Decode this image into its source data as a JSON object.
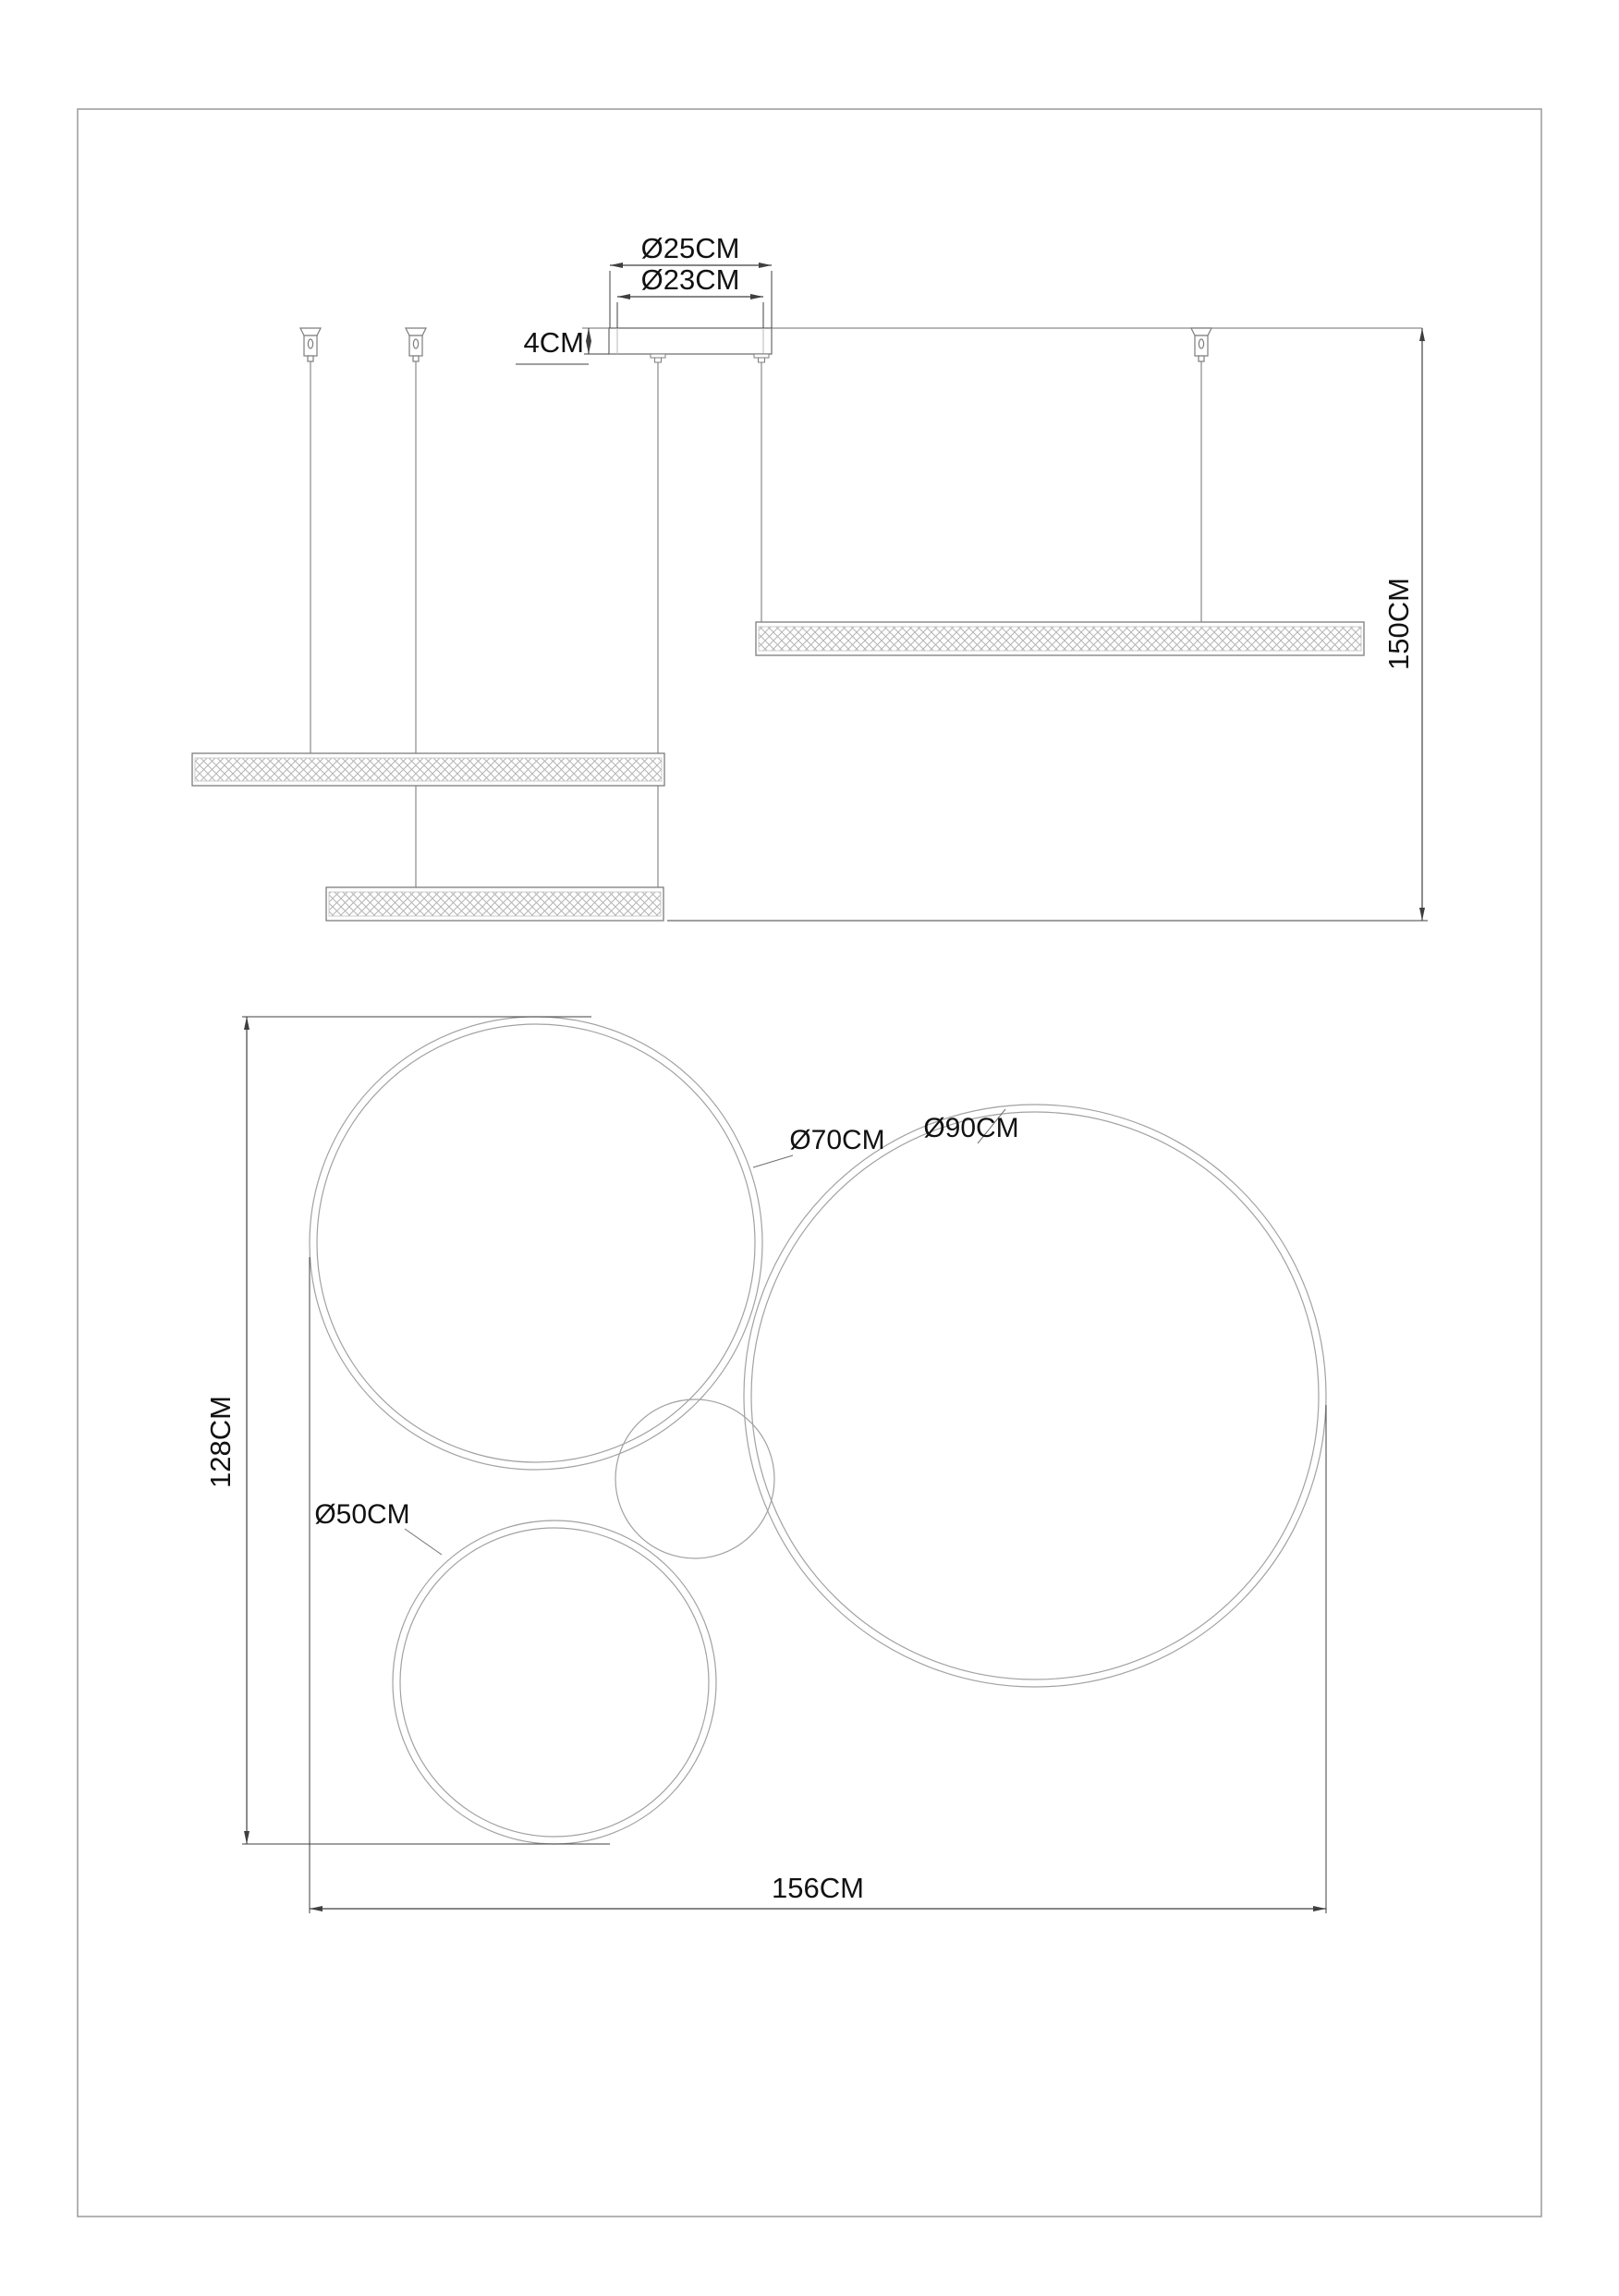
{
  "page": {
    "background": "#ffffff",
    "border_color": "#9a9a9a",
    "line_color": "#8c8c8c",
    "dim_color": "#3f3f3f",
    "hatch_color": "#b5b5b5"
  },
  "side_view": {
    "labels": {
      "canopy_outer": "Ø25CM",
      "canopy_inner": "Ø23CM",
      "canopy_height": "4CM",
      "suspension_drop": "150CM"
    },
    "values_cm": {
      "canopy_outer_diameter": 25,
      "canopy_inner_diameter": 23,
      "canopy_height": 4,
      "suspension_drop": 150
    }
  },
  "plan_view": {
    "labels": {
      "ring_medium": "Ø70CM",
      "ring_large": "Ø90CM",
      "ring_small": "Ø50CM",
      "overall_depth": "128CM",
      "overall_width": "156CM"
    },
    "values_cm": {
      "ring_medium_diameter": 70,
      "ring_large_diameter": 90,
      "ring_small_diameter": 50,
      "overall_depth": 128,
      "overall_width": 156
    }
  }
}
